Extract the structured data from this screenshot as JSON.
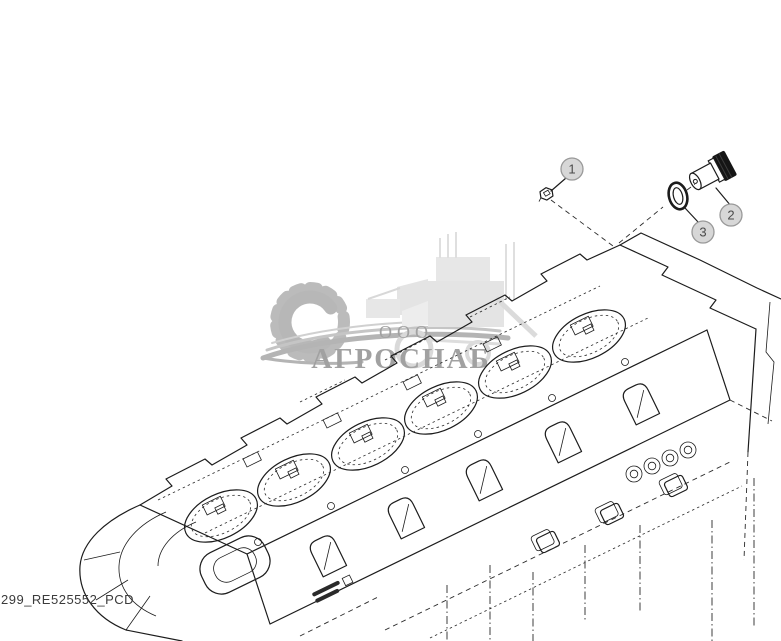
{
  "figure": {
    "footer_code": "299_RE525552_PCD",
    "background": "#ffffff",
    "line_color": "#1c1c1c"
  },
  "watermark": {
    "prefix": "ООО",
    "name": "АГРОСНАБ",
    "text_color": "#9c9c9c",
    "art_color": "#b8b8b8",
    "vehicle_color": "#dedede",
    "icons": [
      "gear-icon",
      "combine-harvester-icon",
      "swoosh-underline"
    ]
  },
  "callouts": [
    {
      "label": "1"
    },
    {
      "label": "2"
    },
    {
      "label": "3"
    }
  ],
  "balloon_style": {
    "fill": "#d7d7d7",
    "stroke": "#999999",
    "text": "#4a4a4a"
  }
}
